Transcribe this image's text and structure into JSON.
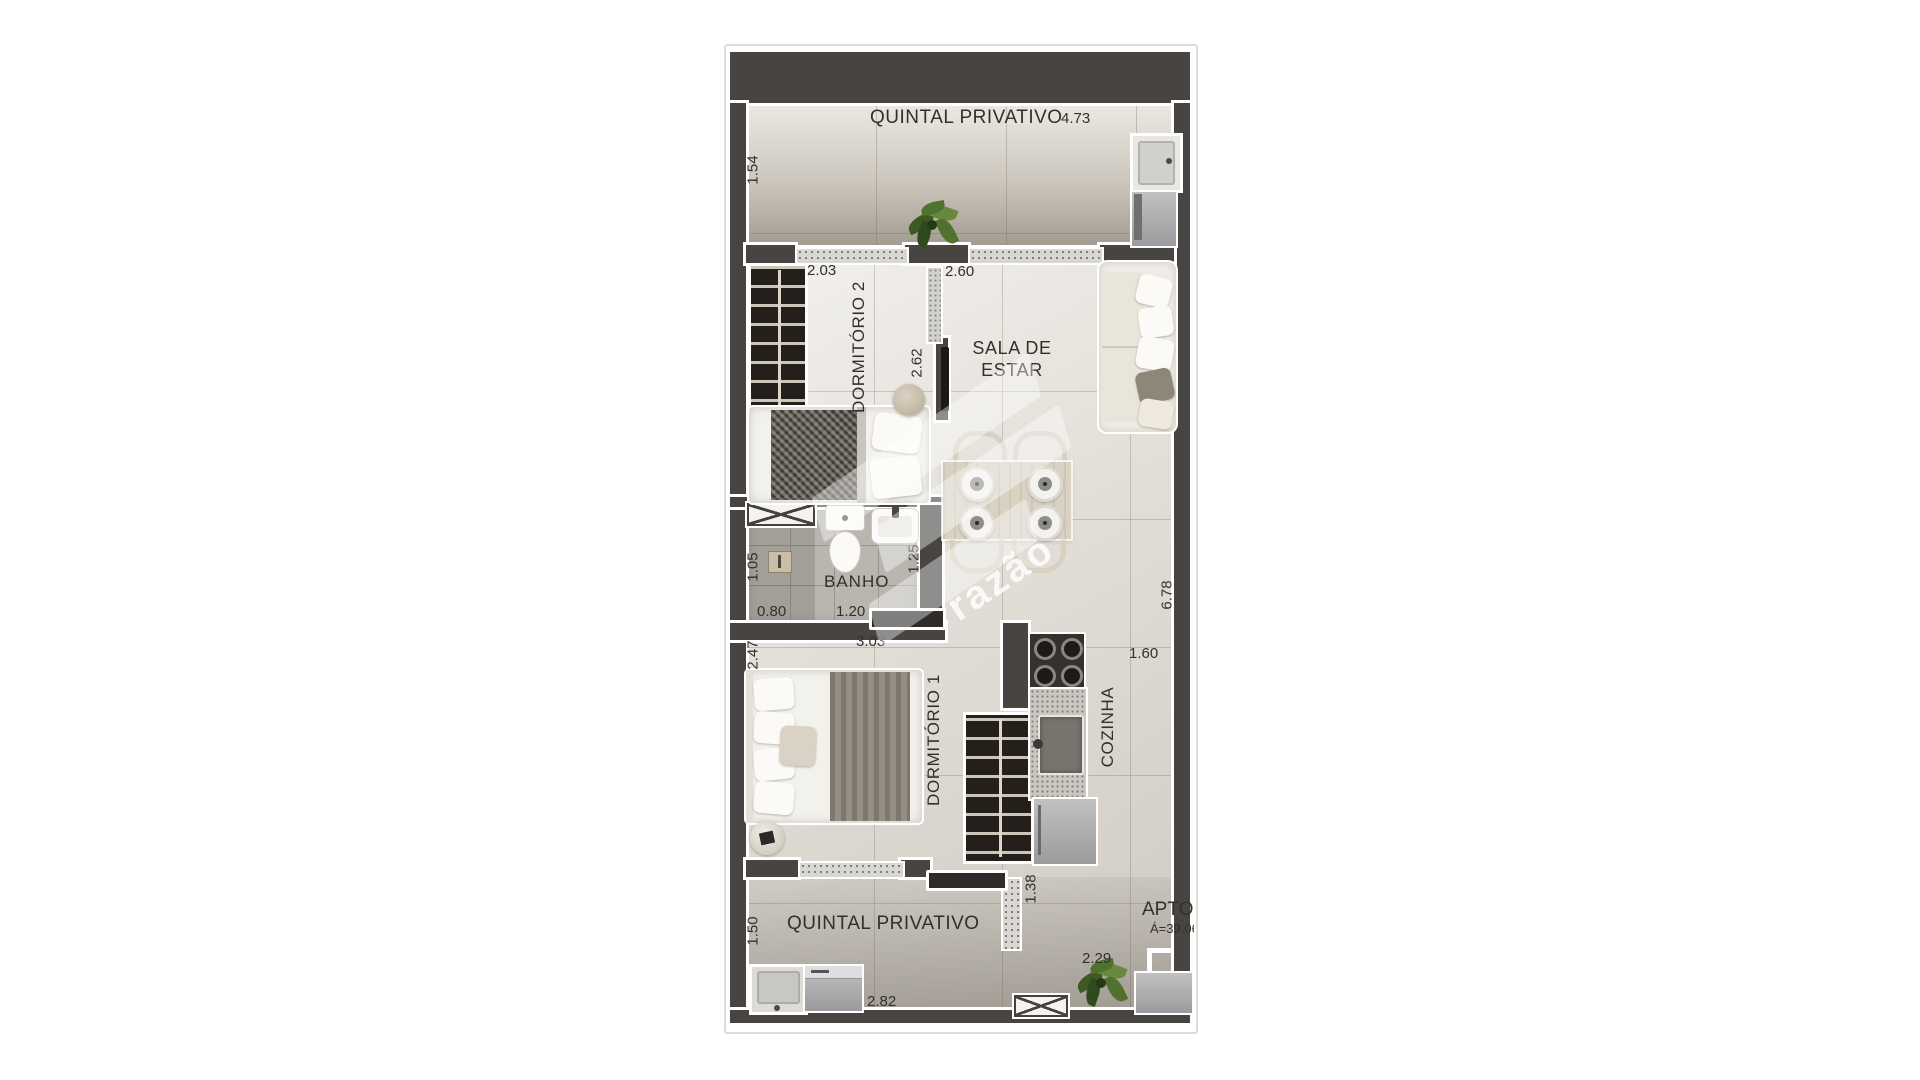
{
  "watermark": {
    "brand": "razão"
  },
  "rooms": {
    "quintal_top": {
      "label": "QUINTAL PRIVATIVO",
      "dim_width": "4.73",
      "dim_depth": "1.54"
    },
    "dormitorio_2": {
      "label": "DORMITÓRIO 2",
      "dim_width": "2.03",
      "dim_depth": "2.62"
    },
    "sala_de_estar": {
      "label": "SALA DE ESTAR",
      "dim_width": "2.60"
    },
    "banho": {
      "label": "BANHO",
      "dim_depth": "1.05",
      "dim_shower_width": "0.80",
      "dim_width": "1.20",
      "dim_right_depth": "1.25"
    },
    "dormitorio_1": {
      "label": "DORMITÓRIO 1",
      "dim_width": "3.03",
      "dim_depth": "2.47"
    },
    "cozinha": {
      "label": "COZINHA",
      "dim_width": "1.60",
      "dim_total_depth": "6.78"
    },
    "quintal_bottom": {
      "label": "QUINTAL PRIVATIVO",
      "dim_depth": "1.50",
      "dim_width": "2.82",
      "dim_passage_width": "1.38",
      "dim_right_width": "2.29"
    },
    "unit": {
      "label": "APTO.",
      "area": "Á=39.06"
    }
  },
  "colors": {
    "wall": "#474441",
    "floor": "#e2ded7",
    "quintal_floor": "#d8d3ca",
    "banho_floor": "#b9b6b0",
    "plant_green": "#51722f",
    "label_text": "#33302b",
    "watermark_white": "#ffffff"
  }
}
